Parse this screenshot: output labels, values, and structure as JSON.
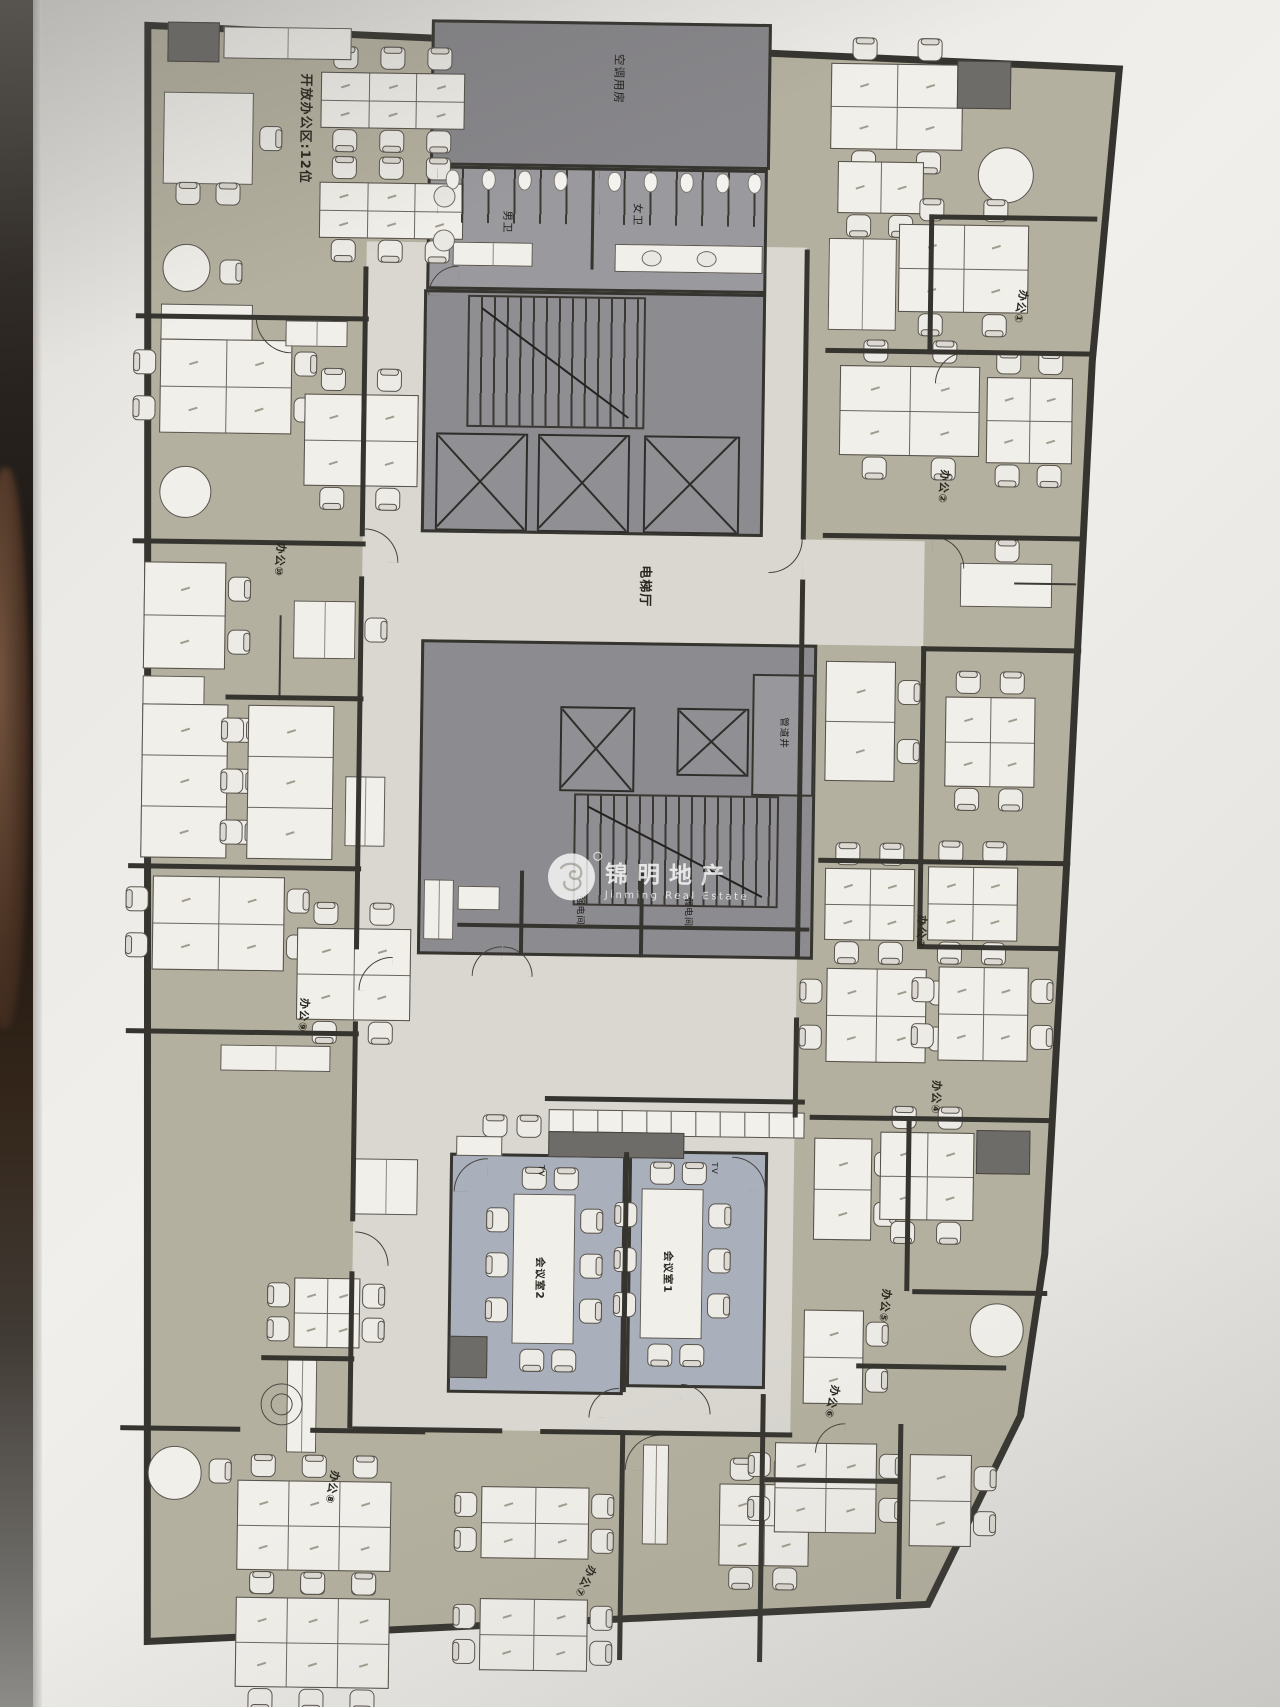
{
  "plan": {
    "labels": {
      "open_office": "开放办公区:12位",
      "ac_room": "空调用房",
      "toilet_men": "男卫",
      "toilet_women": "女卫",
      "elevator_hall": "电梯厅",
      "pipe_shaft": "管道井",
      "strong_power_room": "强电间",
      "weak_power_room": "弱电间",
      "meeting_room_1": "会议室1",
      "meeting_room_2": "会议室2",
      "tv": "TV",
      "office_1": "办公①",
      "office_2": "办公②",
      "office_3": "办公③",
      "office_4": "办公④",
      "office_5": "办公⑤",
      "office_6": "办公⑥",
      "office_7": "办公⑦",
      "office_8": "办公⑧",
      "office_9": "办公⑨",
      "office_10": "办公⑩"
    },
    "watermark": {
      "cn": "锦明地产",
      "en": "Jinming Real Estate"
    },
    "colors": {
      "floor_office": "#b4b09f",
      "floor_corridor": "#d9d7d0",
      "floor_core": "#8c8b8f",
      "floor_meeting": "#a9b0bc",
      "wall": "#36342f",
      "furniture": "#f1efea"
    }
  }
}
